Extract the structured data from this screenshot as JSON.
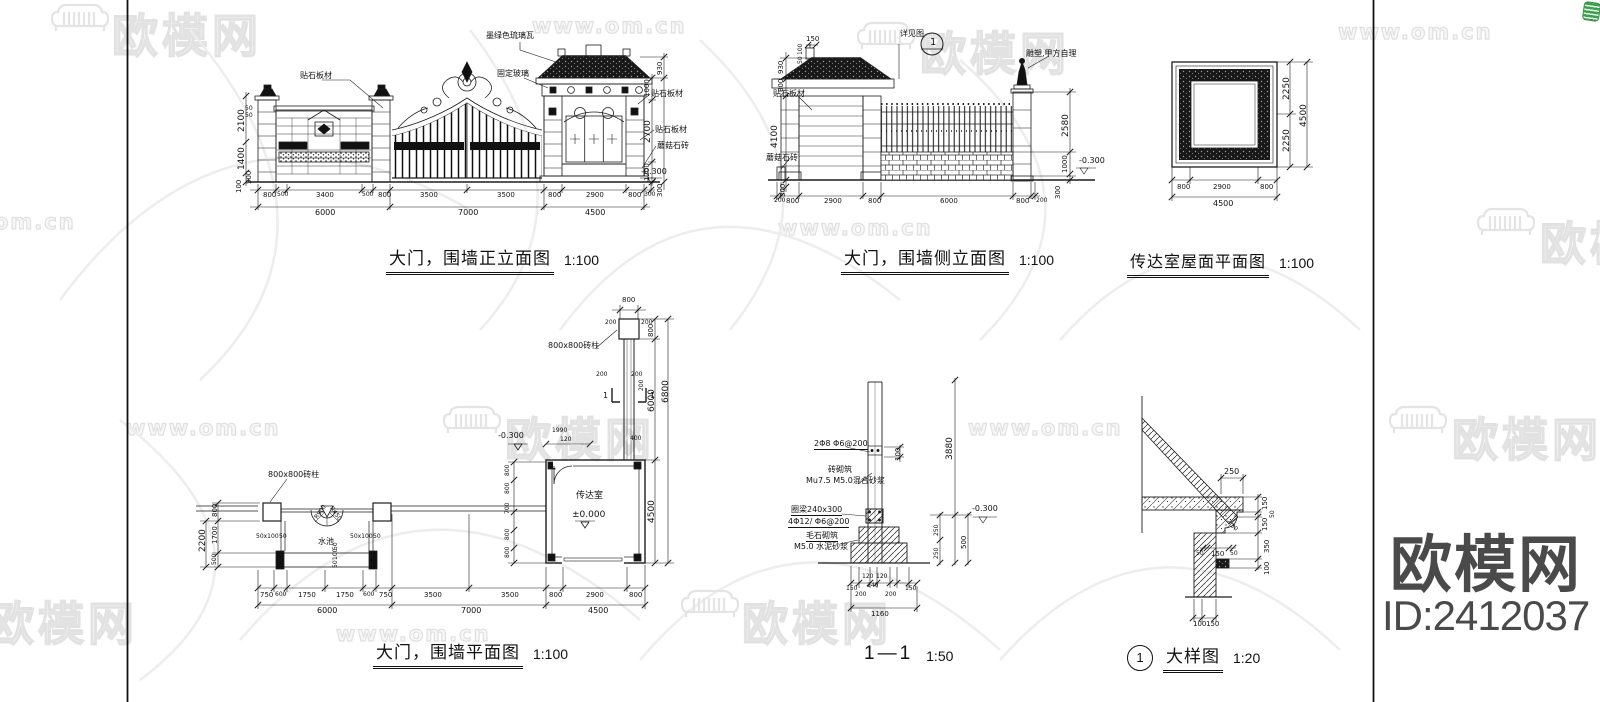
{
  "colors": {
    "line": "#1a1a1a",
    "watermark_gray": "#e2e2e2",
    "brand_gray": "#4a4a4a",
    "corner_icon_green": "#3aa24e"
  },
  "corner_brand": {
    "title": "欧模网",
    "id": "ID:2412037"
  },
  "titles": {
    "front": {
      "text": "大门，围墙正立面图",
      "scale": "1:100"
    },
    "side": {
      "text": "大门，围墙侧立面图",
      "scale": "1:100"
    },
    "roof": {
      "text": "传达室屋面平面图",
      "scale": "1:100"
    },
    "plan": {
      "text": "大门，围墙平面图",
      "scale": "1:100"
    },
    "section": {
      "text": "1—1",
      "scale": "1:50"
    },
    "detail": {
      "text": "大样图",
      "scale": "1:20",
      "bubble": "1"
    }
  },
  "watermarks": {
    "site_marks": [
      {
        "t": "www.om.cn",
        "x": 532,
        "y": 14,
        "c": "wm-site"
      },
      {
        "t": "www.om.cn",
        "x": 1338,
        "y": 20,
        "c": "wm-site"
      },
      {
        "t": "www.om.cn",
        "x": 778,
        "y": 216,
        "c": "wm-site"
      },
      {
        "t": "om.cn",
        "x": -6,
        "y": 210,
        "c": "wm-site"
      },
      {
        "t": "www.om.cn",
        "x": 126,
        "y": 416,
        "c": "wm-site"
      },
      {
        "t": "www.om.cn",
        "x": 968,
        "y": 416,
        "c": "wm-site"
      },
      {
        "t": "www.om.cn",
        "x": 336,
        "y": 622,
        "c": "wm-site"
      }
    ],
    "brand_marks": [
      {
        "t": "欧模网",
        "x": 112,
        "y": 0,
        "c": "wm-brand"
      },
      {
        "t": "欧模网",
        "x": 920,
        "y": 18,
        "c": "wm-brand"
      },
      {
        "t": "欧模网",
        "x": 505,
        "y": 404,
        "c": "wm-brand"
      },
      {
        "t": "欧模网",
        "x": 1452,
        "y": 404,
        "c": "wm-brand"
      },
      {
        "t": "欧模网",
        "x": -12,
        "y": 588,
        "c": "wm-brand"
      },
      {
        "t": "欧模网",
        "x": 742,
        "y": 588,
        "c": "wm-brand"
      },
      {
        "t": "欧模网",
        "x": 1540,
        "y": 208,
        "c": "wm-brand"
      }
    ]
  },
  "drawings": {
    "front_elevation": {
      "labels": [
        {
          "t": "贴石板材",
          "x": 300,
          "y": 72,
          "s": 8
        },
        {
          "t": "墨绿色琉璃瓦",
          "x": 486,
          "y": 32,
          "s": 8
        },
        {
          "t": "固定玻璃",
          "x": 497,
          "y": 70,
          "s": 8
        },
        {
          "t": "贴石板材",
          "x": 651,
          "y": 90,
          "s": 8
        },
        {
          "t": "贴石板材",
          "x": 655,
          "y": 126,
          "s": 8
        },
        {
          "t": "蘑菇石砖",
          "x": 657,
          "y": 142,
          "s": 8
        },
        {
          "t": "-0.300",
          "x": 641,
          "y": 168,
          "s": 8
        },
        {
          "t": "50",
          "x": 245,
          "y": 106,
          "s": 6
        },
        {
          "t": "50",
          "x": 245,
          "y": 113,
          "s": 6
        },
        {
          "t": "2100",
          "x": 238,
          "y": 132,
          "r": -90
        },
        {
          "t": "1400",
          "x": 238,
          "y": 170,
          "r": -90
        },
        {
          "t": "500",
          "x": 246,
          "y": 184,
          "r": -90,
          "s": 7
        },
        {
          "t": "100",
          "x": 236,
          "y": 193,
          "r": -90,
          "s": 7
        },
        {
          "t": "1000",
          "x": 644,
          "y": 97,
          "r": -90,
          "s": 7
        },
        {
          "t": "2700",
          "x": 644,
          "y": 143,
          "r": -90
        },
        {
          "t": "1200",
          "x": 644,
          "y": 181,
          "r": -90,
          "s": 7
        },
        {
          "t": "930",
          "x": 657,
          "y": 75,
          "r": -90,
          "s": 7
        },
        {
          "t": "300",
          "x": 657,
          "y": 197,
          "r": -90,
          "s": 7
        },
        {
          "t": "800",
          "x": 263,
          "y": 192,
          "s": 7
        },
        {
          "t": "500",
          "x": 277,
          "y": 192,
          "s": 6
        },
        {
          "t": "3400",
          "x": 316,
          "y": 192,
          "s": 7
        },
        {
          "t": "500",
          "x": 362,
          "y": 192,
          "s": 6
        },
        {
          "t": "800",
          "x": 378,
          "y": 192,
          "s": 7
        },
        {
          "t": "3500",
          "x": 420,
          "y": 192,
          "s": 7
        },
        {
          "t": "3500",
          "x": 497,
          "y": 192,
          "s": 7
        },
        {
          "t": "800",
          "x": 548,
          "y": 192,
          "s": 7
        },
        {
          "t": "2900",
          "x": 586,
          "y": 192,
          "s": 7
        },
        {
          "t": "800",
          "x": 628,
          "y": 192,
          "s": 7
        },
        {
          "t": "300",
          "x": 644,
          "y": 192,
          "s": 6
        },
        {
          "t": "6000",
          "x": 315,
          "y": 209,
          "s": 8
        },
        {
          "t": "7000",
          "x": 458,
          "y": 209,
          "s": 8
        },
        {
          "t": "4500",
          "x": 585,
          "y": 209,
          "s": 8
        }
      ]
    },
    "side_elevation": {
      "labels": [
        {
          "t": "详见图",
          "x": 900,
          "y": 30,
          "s": 8
        },
        {
          "t": "1",
          "x": 930,
          "y": 38,
          "s": 10
        },
        {
          "t": "雕塑,甲方自理",
          "x": 1026,
          "y": 50,
          "s": 8
        },
        {
          "t": "贴石板材",
          "x": 773,
          "y": 90,
          "s": 8
        },
        {
          "t": "蘑菇石砖",
          "x": 766,
          "y": 154,
          "s": 8
        },
        {
          "t": "-0.300",
          "x": 1079,
          "y": 157,
          "s": 8
        },
        {
          "t": "150",
          "x": 806,
          "y": 36,
          "s": 7
        },
        {
          "t": "100",
          "x": 798,
          "y": 55,
          "r": -90,
          "s": 6
        },
        {
          "t": "50",
          "x": 798,
          "y": 64,
          "r": -90,
          "s": 6
        },
        {
          "t": "930",
          "x": 778,
          "y": 74,
          "r": -90,
          "s": 7
        },
        {
          "t": "800",
          "x": 778,
          "y": 92,
          "r": -90,
          "s": 7
        },
        {
          "t": "4100",
          "x": 771,
          "y": 148,
          "r": -90
        },
        {
          "t": "300",
          "x": 780,
          "y": 197,
          "r": -90,
          "s": 7
        },
        {
          "t": "2580",
          "x": 1062,
          "y": 137,
          "r": -90
        },
        {
          "t": "1000",
          "x": 1062,
          "y": 173,
          "r": -90,
          "s": 7
        },
        {
          "t": "300",
          "x": 1055,
          "y": 199,
          "r": -90,
          "s": 7
        },
        {
          "t": "200",
          "x": 774,
          "y": 198,
          "s": 6
        },
        {
          "t": "800",
          "x": 786,
          "y": 198,
          "s": 7
        },
        {
          "t": "2900",
          "x": 824,
          "y": 198,
          "s": 7
        },
        {
          "t": "800",
          "x": 868,
          "y": 198,
          "s": 7
        },
        {
          "t": "6000",
          "x": 940,
          "y": 198,
          "s": 7
        },
        {
          "t": "800",
          "x": 1016,
          "y": 198,
          "s": 7
        },
        {
          "t": "200",
          "x": 1036,
          "y": 198,
          "s": 6
        }
      ]
    },
    "roof_plan": {
      "labels": [
        {
          "t": "2250",
          "x": 1283,
          "y": 100,
          "r": -90
        },
        {
          "t": "2250",
          "x": 1283,
          "y": 152,
          "r": -90
        },
        {
          "t": "4500",
          "x": 1300,
          "y": 127,
          "r": -90
        },
        {
          "t": "800",
          "x": 1177,
          "y": 184,
          "s": 7
        },
        {
          "t": "2900",
          "x": 1213,
          "y": 184,
          "s": 7
        },
        {
          "t": "800",
          "x": 1260,
          "y": 184,
          "s": 7
        },
        {
          "t": "4500",
          "x": 1213,
          "y": 200,
          "s": 8
        }
      ]
    },
    "plan": {
      "labels": [
        {
          "t": "800x800砖柱",
          "x": 268,
          "y": 471,
          "s": 8
        },
        {
          "t": "800x800砖柱",
          "x": 548,
          "y": 342,
          "s": 8
        },
        {
          "t": "水池",
          "x": 318,
          "y": 538,
          "s": 8
        },
        {
          "t": "R900",
          "x": 314,
          "y": 517,
          "r": -55,
          "s": 6
        },
        {
          "t": "R450",
          "x": 333,
          "y": 506,
          "r": 55,
          "s": 6
        },
        {
          "t": "传达室",
          "x": 576,
          "y": 492,
          "s": 9
        },
        {
          "t": "±0.000",
          "x": 572,
          "y": 511,
          "s": 9
        },
        {
          "t": "-0.300",
          "x": 498,
          "y": 432,
          "s": 8
        },
        {
          "t": "1990",
          "x": 552,
          "y": 428,
          "s": 6
        },
        {
          "t": "120",
          "x": 560,
          "y": 437,
          "s": 6
        },
        {
          "t": "1",
          "x": 603,
          "y": 392,
          "s": 8
        },
        {
          "t": "1",
          "x": 650,
          "y": 392,
          "s": 8
        },
        {
          "t": "200",
          "x": 596,
          "y": 372,
          "s": 6
        },
        {
          "t": "200",
          "x": 631,
          "y": 372,
          "s": 6
        },
        {
          "t": "200",
          "x": 639,
          "y": 391,
          "r": -90,
          "s": 6
        },
        {
          "t": "800",
          "x": 622,
          "y": 297,
          "s": 7
        },
        {
          "t": "200",
          "x": 605,
          "y": 320,
          "s": 6
        },
        {
          "t": "200",
          "x": 641,
          "y": 320,
          "s": 6
        },
        {
          "t": "800",
          "x": 648,
          "y": 337,
          "r": -90,
          "s": 7
        },
        {
          "t": "6000",
          "x": 648,
          "y": 412,
          "r": -90
        },
        {
          "t": "6800",
          "x": 662,
          "y": 403,
          "r": -90
        },
        {
          "t": "400",
          "x": 630,
          "y": 436,
          "s": 6
        },
        {
          "t": "4500",
          "x": 648,
          "y": 523,
          "r": -90
        },
        {
          "t": "800",
          "x": 505,
          "y": 476,
          "r": -90,
          "s": 6
        },
        {
          "t": "800",
          "x": 505,
          "y": 494,
          "r": -90,
          "s": 6
        },
        {
          "t": "700",
          "x": 505,
          "y": 514,
          "r": -90,
          "s": 6
        },
        {
          "t": "800",
          "x": 505,
          "y": 540,
          "r": -90,
          "s": 6
        },
        {
          "t": "800",
          "x": 505,
          "y": 558,
          "r": -90,
          "s": 6
        },
        {
          "t": "50x100",
          "x": 256,
          "y": 534,
          "s": 6
        },
        {
          "t": "50",
          "x": 279,
          "y": 534,
          "s": 6
        },
        {
          "t": "50x100",
          "x": 350,
          "y": 534,
          "s": 6
        },
        {
          "t": "50",
          "x": 373,
          "y": 534,
          "s": 6
        },
        {
          "t": "50",
          "x": 333,
          "y": 550,
          "r": -90,
          "s": 6
        },
        {
          "t": "100",
          "x": 333,
          "y": 560,
          "r": -90,
          "s": 6
        },
        {
          "t": "50",
          "x": 333,
          "y": 568,
          "r": -90,
          "s": 6
        },
        {
          "t": "800",
          "x": 212,
          "y": 517,
          "r": -90,
          "s": 7
        },
        {
          "t": "1700",
          "x": 212,
          "y": 544,
          "r": -90,
          "s": 7
        },
        {
          "t": "500",
          "x": 212,
          "y": 565,
          "r": -90,
          "s": 6
        },
        {
          "t": "2200",
          "x": 199,
          "y": 552,
          "r": -90
        },
        {
          "t": "750",
          "x": 260,
          "y": 592,
          "s": 7
        },
        {
          "t": "600",
          "x": 275,
          "y": 592,
          "s": 6
        },
        {
          "t": "1750",
          "x": 298,
          "y": 592,
          "s": 7
        },
        {
          "t": "1750",
          "x": 336,
          "y": 592,
          "s": 7
        },
        {
          "t": "600",
          "x": 363,
          "y": 592,
          "s": 6
        },
        {
          "t": "750",
          "x": 379,
          "y": 592,
          "s": 7
        },
        {
          "t": "3500",
          "x": 424,
          "y": 592,
          "s": 7
        },
        {
          "t": "3500",
          "x": 501,
          "y": 592,
          "s": 7
        },
        {
          "t": "800",
          "x": 549,
          "y": 592,
          "s": 7
        },
        {
          "t": "2900",
          "x": 586,
          "y": 592,
          "s": 7
        },
        {
          "t": "800",
          "x": 629,
          "y": 592,
          "s": 7
        },
        {
          "t": "6000",
          "x": 317,
          "y": 607,
          "s": 8
        },
        {
          "t": "7000",
          "x": 461,
          "y": 607,
          "s": 8
        },
        {
          "t": "4500",
          "x": 588,
          "y": 607,
          "s": 8
        }
      ]
    },
    "section": {
      "labels": [
        {
          "t": "2Φ8  Φ6@200",
          "x": 814,
          "y": 440,
          "s": 8,
          "u": 1
        },
        {
          "t": "砖砌筑",
          "x": 828,
          "y": 466,
          "s": 8
        },
        {
          "t": "Mu7.5 M5.0混合砂浆",
          "x": 806,
          "y": 477,
          "s": 8
        },
        {
          "t": "圈梁240x300",
          "x": 791,
          "y": 506,
          "s": 8,
          "u": 1
        },
        {
          "t": "4Φ12/ Φ6@200",
          "x": 788,
          "y": 518,
          "s": 8,
          "u": 1
        },
        {
          "t": "毛石砌筑",
          "x": 806,
          "y": 532,
          "s": 8,
          "u": 1
        },
        {
          "t": "M5.0 水泥砂浆",
          "x": 794,
          "y": 543,
          "s": 8
        },
        {
          "t": "100",
          "x": 895,
          "y": 461,
          "r": -90,
          "s": 7
        },
        {
          "t": "3880",
          "x": 946,
          "y": 460,
          "r": -90
        },
        {
          "t": "250",
          "x": 934,
          "y": 536,
          "r": -90,
          "s": 6
        },
        {
          "t": "250",
          "x": 934,
          "y": 559,
          "r": -90,
          "s": 6
        },
        {
          "t": "500",
          "x": 961,
          "y": 549,
          "r": -90,
          "s": 7
        },
        {
          "t": "-0.300",
          "x": 972,
          "y": 505,
          "s": 8
        },
        {
          "t": "150",
          "x": 846,
          "y": 586,
          "s": 6
        },
        {
          "t": "120",
          "x": 862,
          "y": 574,
          "s": 6
        },
        {
          "t": "120",
          "x": 876,
          "y": 574,
          "s": 6
        },
        {
          "t": "240",
          "x": 867,
          "y": 583,
          "s": 6
        },
        {
          "t": "200",
          "x": 855,
          "y": 592,
          "s": 6
        },
        {
          "t": "200",
          "x": 885,
          "y": 592,
          "s": 6
        },
        {
          "t": "150",
          "x": 905,
          "y": 586,
          "s": 6
        },
        {
          "t": "1160",
          "x": 871,
          "y": 611,
          "s": 7
        }
      ]
    },
    "detail": {
      "labels": [
        {
          "t": "250",
          "x": 1224,
          "y": 468,
          "s": 8
        },
        {
          "t": "150",
          "x": 1262,
          "y": 510,
          "r": -90,
          "s": 7
        },
        {
          "t": "50",
          "x": 1270,
          "y": 518,
          "r": -90,
          "s": 6
        },
        {
          "t": "150",
          "x": 1262,
          "y": 531,
          "r": -90,
          "s": 7
        },
        {
          "t": "350",
          "x": 1264,
          "y": 553,
          "r": -90,
          "s": 7
        },
        {
          "t": "100",
          "x": 1264,
          "y": 575,
          "r": -90,
          "s": 7
        },
        {
          "t": "50",
          "x": 1196,
          "y": 551,
          "s": 6
        },
        {
          "t": "150",
          "x": 1211,
          "y": 551,
          "s": 7
        },
        {
          "t": "50",
          "x": 1230,
          "y": 551,
          "s": 6
        },
        {
          "t": "30",
          "x": 1233,
          "y": 523,
          "r": 45,
          "s": 6
        },
        {
          "t": "100",
          "x": 1193,
          "y": 621,
          "s": 7
        },
        {
          "t": "150",
          "x": 1206,
          "y": 621,
          "s": 7
        }
      ]
    }
  }
}
